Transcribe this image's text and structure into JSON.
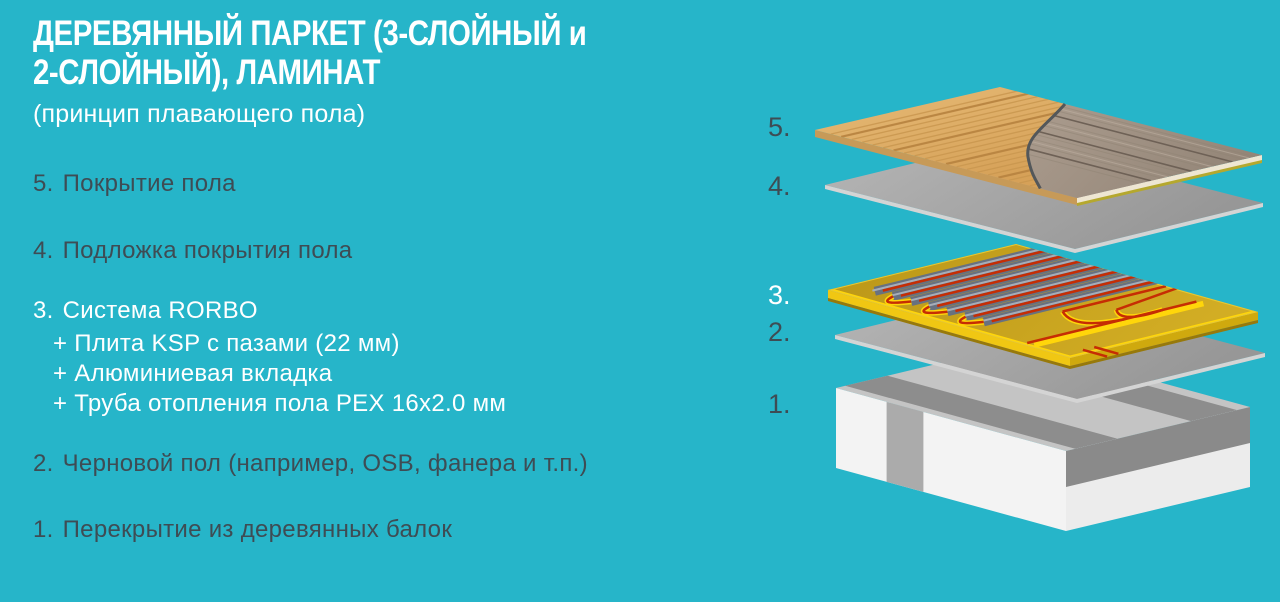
{
  "title": {
    "line1": "ДЕРЕВЯННЫЙ ПАРКЕТ (3-СЛОЙНЫЙ и",
    "line2": "2-СЛОЙНЫЙ), ЛАМИНАТ",
    "subtitle": "(принцип плавающего пола)"
  },
  "list": {
    "items": [
      {
        "num": "5.",
        "label": "Покрытие пола"
      },
      {
        "num": "4.",
        "label": "Подложка покрытия пола"
      },
      {
        "num": "3.",
        "label": "Система RORBO",
        "sub": [
          "+ Плита KSP с пазами (22 мм)",
          "+ Алюминиевая вкладка",
          "+ Труба отопления пола PEX 16x2.0 мм"
        ]
      },
      {
        "num": "2.",
        "label": "Черновой пол (например, OSB, фанера и т.п.)"
      },
      {
        "num": "1.",
        "label": "Перекрытие из деревянных балок"
      }
    ]
  },
  "diagram": {
    "labels": [
      "5.",
      "4.",
      "3.",
      "2.",
      "1."
    ]
  },
  "colors": {
    "background": "#26b5c9",
    "text_dark": "#3e4c54",
    "text_light": "#ffffff",
    "wood_light": "#dfae67",
    "laminate": "#a29282",
    "underlay_gray": "#a8a8a8",
    "board_yellow": "#c6a11e",
    "edge_yellow": "#ffd60a",
    "strip_gray": "#68717f",
    "pipe_red": "#c62d04",
    "beam_gray": "#8d8d8d",
    "slab_white": "#f3f3f3"
  }
}
